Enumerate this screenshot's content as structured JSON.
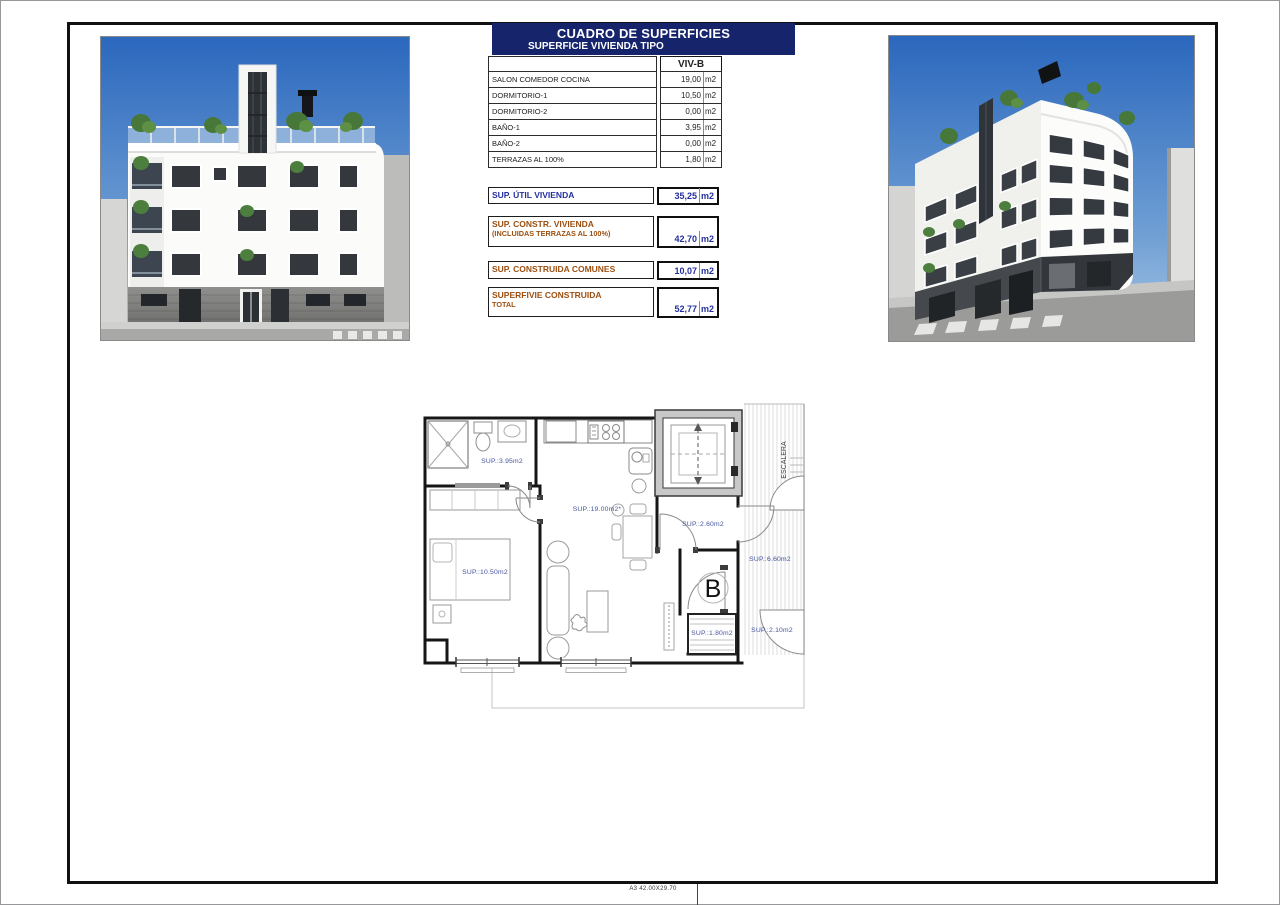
{
  "sheet": {
    "paper_note": "A3 42.00X29.70"
  },
  "surface_table": {
    "title": "CUADRO DE SUPERFICIES",
    "subtitle": "SUPERFICIE VIVIENDA TIPO",
    "column_header": "VIV-B",
    "unit": "m2",
    "rows": [
      {
        "label": "SALON COMEDOR COCINA",
        "value": "19,00"
      },
      {
        "label": "DORMITORIO-1",
        "value": "10,50"
      },
      {
        "label": "DORMITORIO-2",
        "value": "0,00"
      },
      {
        "label": "BAÑO-1",
        "value": "3,95"
      },
      {
        "label": "BAÑO-2",
        "value": "0,00"
      },
      {
        "label": "TERRAZAS AL 100%",
        "value": "1,80"
      }
    ],
    "summary": [
      {
        "label": "SUP. ÚTIL VIVIENDA",
        "label2": "",
        "value": "35,25"
      },
      {
        "label": "SUP. CONSTR. VIVIENDA",
        "label2": "(INCLUIDAS TERRAZAS AL 100%)",
        "value": "42,70"
      },
      {
        "label": "SUP. CONSTRUIDA COMUNES",
        "label2": "",
        "value": "10,07"
      },
      {
        "label": "SUPERFIVIE CONSTRUIDA",
        "label2": "TOTAL",
        "value": "52,77"
      }
    ]
  },
  "floor_plan": {
    "labels": {
      "bathroom": "SUP.:3.95m2",
      "living_kitchen": "SUP.:19.00m2*",
      "bedroom": "SUP.:10.50m2",
      "hall": "SUP.:2.60m2",
      "landing": "SUP.:6.60m2",
      "terrace": "SUP.:1.80m2",
      "entry": "SUP.:2.10m2",
      "stairs": "ESCALERA",
      "unit_letter": "B"
    }
  }
}
